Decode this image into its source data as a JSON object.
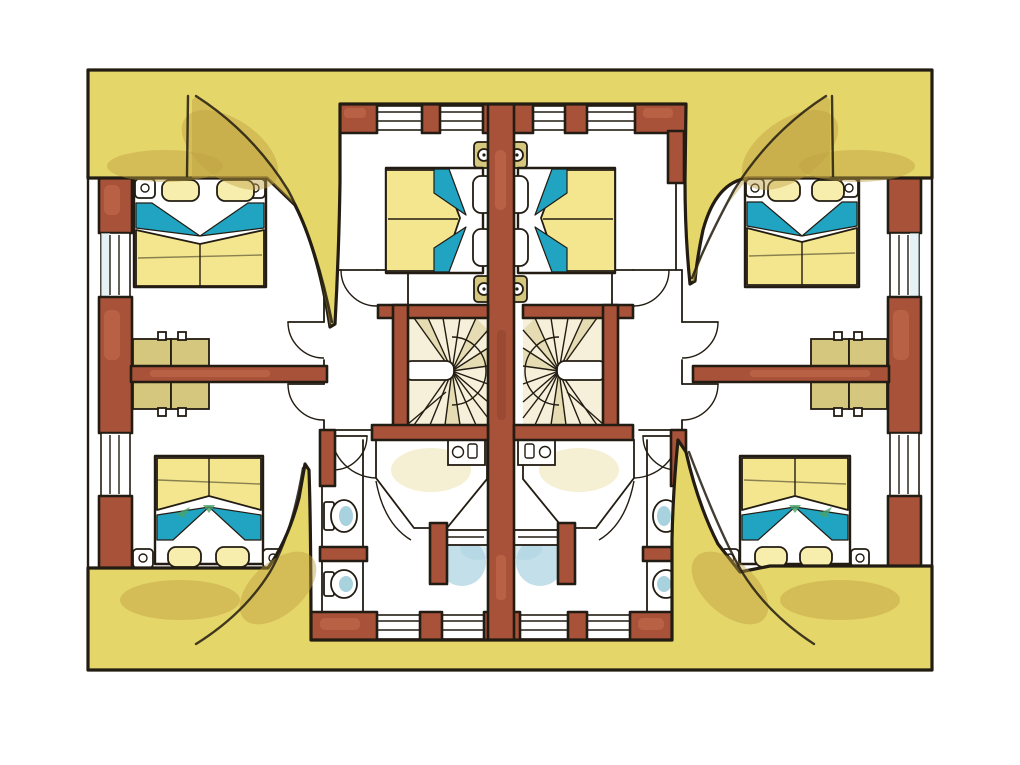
{
  "meta": {
    "title": "Hand-painted watercolour floor plan of a semi-detached holiday house (bedroom storey, two mirrored units)",
    "diagram_type": "architectural floor plan",
    "view": "top-down plan view",
    "medium": "ink and watercolour"
  },
  "palette": {
    "paper": "#ffffff",
    "line": "#221c12",
    "roof": "#e5d669",
    "roof_shade": "#bf9f42",
    "wall_red": "#a8523a",
    "wall_red_light": "#c96f50",
    "wall_red_dark": "#8a3e2c",
    "bed_yellow": "#f3e68f",
    "pillow": "#f7eead",
    "teal": "#21a3c2",
    "green_tinge": "#4aa269",
    "wardrobe_tan": "#d6c77e",
    "stair_cream": "#f6f0da",
    "stair_shade": "#e3d8ab",
    "bath_blue": "#a9d2df",
    "window_glass": "#cfe6ec"
  },
  "inventory": {
    "dwelling_units": 2,
    "double_beds": 6,
    "winder_staircases": 2,
    "bathrooms": 2,
    "wc_rooms": 2,
    "toilets": 4,
    "showers": 2,
    "wardrobe_walls": 2,
    "door_swings": 12,
    "thatched_roof_areas": "top and bottom bands with four curved eave sweeps"
  }
}
